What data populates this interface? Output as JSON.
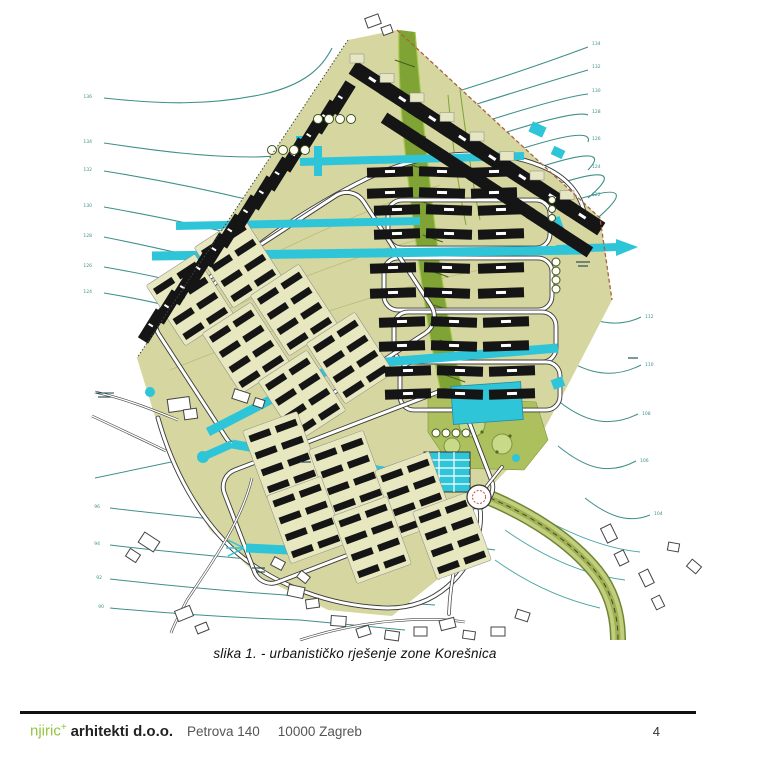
{
  "figure": {
    "caption": "slika 1. - urbanističko rješenje zone Korešnica"
  },
  "footer": {
    "brand": "njiric",
    "brand_sup": "+",
    "company": "arhitekti d.o.o.",
    "street": "Petrova 140",
    "city": "10000 Zagreb",
    "page_number": "4"
  },
  "map": {
    "kind": "urban-masterplan",
    "zone_name": "Korešnica",
    "colors": {
      "site": "#d6d7a0",
      "block_pad": "#e7e7c0",
      "building": "#151515",
      "water_street": "#2fc5d8",
      "contour": "#3f8f8a",
      "greenway": "#7fa335",
      "park": "#adc05e",
      "road_casing": "#3a3a3a",
      "boundary_dash": "#a9613f"
    },
    "contour_labels_left": [
      {
        "x": 92,
        "y": 98,
        "t": "136"
      },
      {
        "x": 92,
        "y": 143,
        "t": "134"
      },
      {
        "x": 92,
        "y": 171,
        "t": "132"
      },
      {
        "x": 92,
        "y": 207,
        "t": "130"
      },
      {
        "x": 92,
        "y": 237,
        "t": "128"
      },
      {
        "x": 92,
        "y": 267,
        "t": "126"
      },
      {
        "x": 92,
        "y": 293,
        "t": "124"
      }
    ],
    "contour_labels_top_right": [
      {
        "x": 592,
        "y": 45,
        "t": "134"
      },
      {
        "x": 592,
        "y": 68,
        "t": "132"
      },
      {
        "x": 592,
        "y": 92,
        "t": "130"
      },
      {
        "x": 592,
        "y": 113,
        "t": "128"
      },
      {
        "x": 592,
        "y": 140,
        "t": "126"
      },
      {
        "x": 592,
        "y": 168,
        "t": "124"
      },
      {
        "x": 592,
        "y": 196,
        "t": "122"
      },
      {
        "x": 592,
        "y": 224,
        "t": "120"
      }
    ],
    "contour_labels_right": [
      {
        "x": 645,
        "y": 318,
        "t": "112"
      },
      {
        "x": 645,
        "y": 366,
        "t": "110"
      },
      {
        "x": 642,
        "y": 415,
        "t": "108"
      },
      {
        "x": 640,
        "y": 462,
        "t": "106"
      },
      {
        "x": 654,
        "y": 515,
        "t": "104"
      }
    ],
    "contour_labels_bottom_left": [
      {
        "x": 100,
        "y": 508,
        "t": "96"
      },
      {
        "x": 100,
        "y": 545,
        "t": "94"
      },
      {
        "x": 102,
        "y": 579,
        "t": "92"
      },
      {
        "x": 104,
        "y": 608,
        "t": "90"
      }
    ]
  }
}
